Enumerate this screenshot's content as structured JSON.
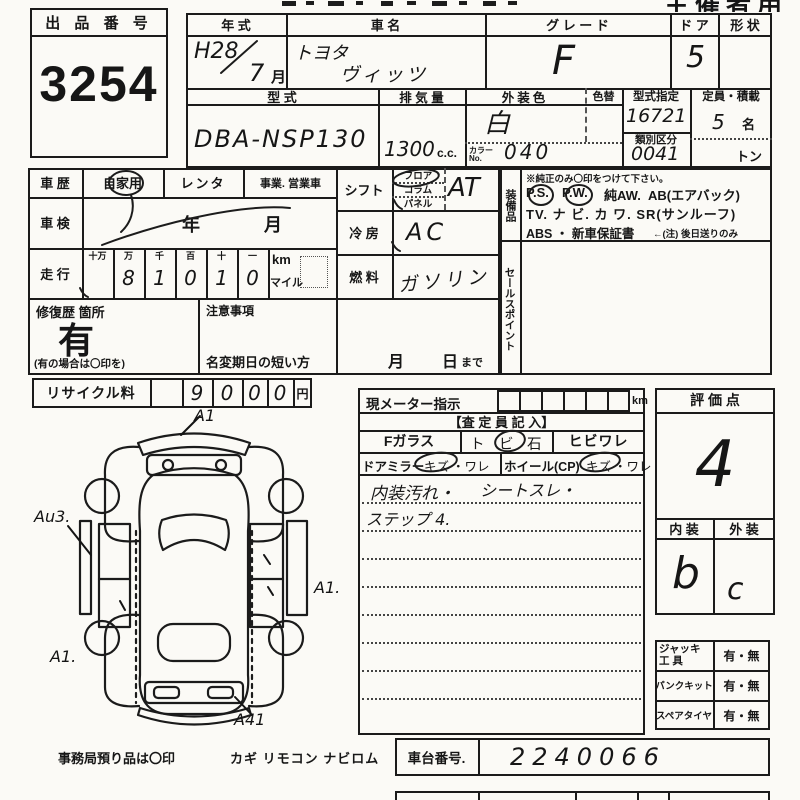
{
  "header": {
    "use_label": "主催者用"
  },
  "auction": {
    "label": "出 品 番 号",
    "value": "3254"
  },
  "top": {
    "year_label": "年    式",
    "year_value": "H28",
    "month_value": "7",
    "month_unit": "月",
    "name_label": "車      名",
    "maker": "トヨタ",
    "model_name": "ヴィッツ",
    "grade_label": "グ レ ー ド",
    "grade_value": "F",
    "door_label": "ド ア",
    "door_value": "5",
    "shape_label": "形 状",
    "model_label": "型    式",
    "model_code": "DBA-NSP130",
    "disp_label": "排 気 量",
    "disp_value": "1300",
    "disp_unit": "c.c.",
    "color_label": "外装色",
    "color_change_label": "色替",
    "color_value": "白",
    "color_no_label1": "カラー",
    "color_no_label2": "No.",
    "color_no_value": "040",
    "type_label": "型式指定",
    "type_value": "16721",
    "class_label": "類別区分",
    "class_value": "0041",
    "capacity_label": "定員・積載",
    "capacity_value": "5",
    "capacity_unit": "名",
    "load_unit": "トン"
  },
  "left": {
    "history_label": "車  歴",
    "history_private": "自家用",
    "history_rental": "レンタ",
    "history_business": "事業. 営業車",
    "inspection_label": "車  検",
    "inspection_year": "年",
    "inspection_month": "月",
    "mileage_label": "走  行",
    "mileage_headers": [
      "十万",
      "万",
      "千",
      "百",
      "十",
      "一"
    ],
    "mileage_digits": [
      "",
      "8",
      "1",
      "0",
      "1",
      "0"
    ],
    "unit_km": "km",
    "unit_mile": "マイル",
    "repair_label": "修復歴 箇所",
    "repair_value": "有",
    "repair_note": "(有の場合は〇印を)",
    "caution_label": "注意事項",
    "caution_text": "名変期日の短い方",
    "caution_month": "月",
    "caution_day": "日",
    "caution_until": "まで"
  },
  "mid": {
    "shift_label": "シフト",
    "shift_options": [
      "フロア",
      "コラム",
      "パネル"
    ],
    "shift_value": "AT",
    "cool_label": "冷 房",
    "cool_value": "AC",
    "fuel_label": "燃 料",
    "fuel_value": "ガソリン"
  },
  "equip": {
    "label": "装備品",
    "note": "※純正のみ〇印をつけて下さい。",
    "item1": "P.S.",
    "item2": "P.W.",
    "item3": "純AW.",
    "item4": "AB(エアバック)",
    "line2": "TV. ナ ビ. カ ワ.  SR(サンルーフ)",
    "line3a": "ABS ・ 新車保証書",
    "line3b": "←(注) 後日送りのみ",
    "sales_label": "セールスポイント"
  },
  "recycle": {
    "label": "リサイクル料",
    "digits": [
      "9",
      "0",
      "0",
      "0"
    ],
    "unit": "円"
  },
  "meter": {
    "label": "現メーター指示",
    "unit_km": "km",
    "assessor_header": "【査 定 員 記 入】",
    "fglass_label": "Fガラス",
    "fglass_o1": "ト",
    "fglass_o2": "ビ",
    "fglass_o3": "石",
    "fglass_crack": "ヒビワレ",
    "mirror_label": "ドアミラー",
    "mirror_o1": "キズ",
    "mirror_o2": "・ワレ",
    "wheel_label": "ホイール(CP)",
    "wheel_o1": "キズ",
    "wheel_o2": "・ワレ",
    "note1a": "内装汚れ・",
    "note1b": "シートスレ・",
    "note2": "ステップ 4."
  },
  "eval": {
    "label": "評  価  点",
    "score": "4",
    "interior_label": "内  装",
    "exterior_label": "外  装",
    "interior_value": "b",
    "exterior_value": "c"
  },
  "tools": {
    "jack_label1": "ジャッキ",
    "jack_label2": "工    具",
    "jack_value": "有・無",
    "puncture_label": "パンクキット",
    "puncture_value": "有・無",
    "spare_label": "スペアタイヤ",
    "spare_value": "有・無"
  },
  "chassis": {
    "label": "車台番号.",
    "value": "2240066"
  },
  "footer": {
    "office_note": "事務局預り品は〇印",
    "items": "カギ  リモコン  ナビロム"
  },
  "diagram": {
    "mark_top": "A1",
    "mark_left": "Au3.",
    "mark_right": "A1.",
    "mark_bottom_left": "A1.",
    "mark_bottom_right": "A41"
  }
}
